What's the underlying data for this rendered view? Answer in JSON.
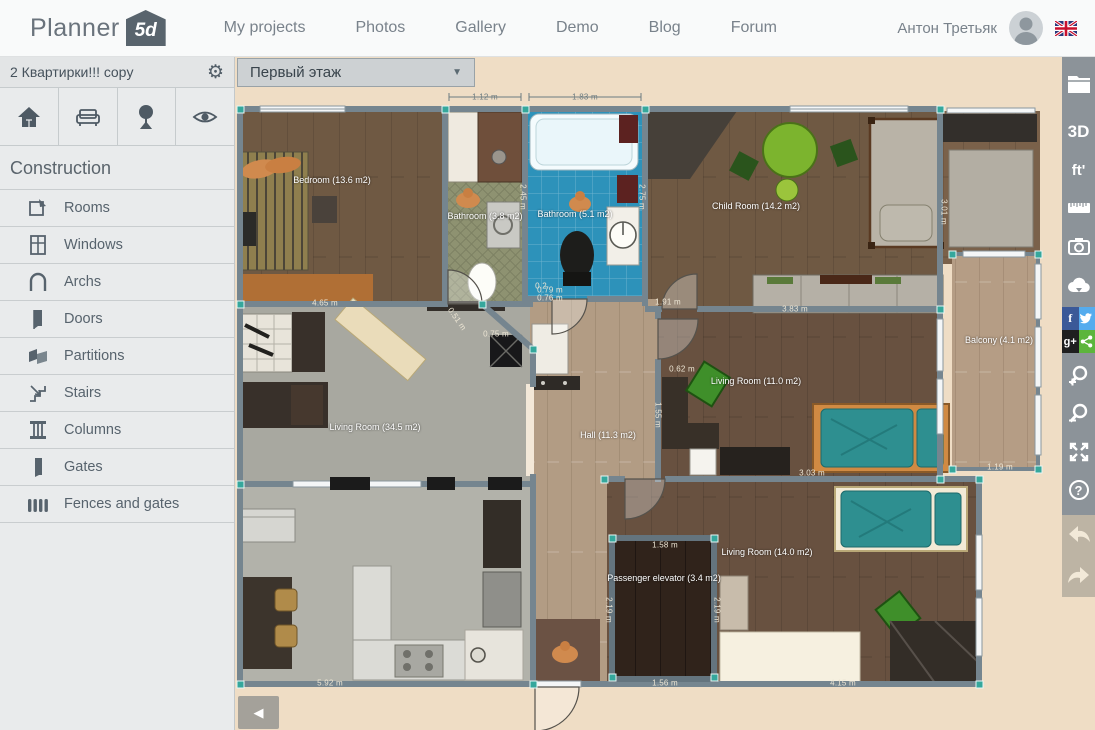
{
  "nav": {
    "logo_text": "Planner",
    "logo_badge": "5d",
    "items": [
      "My projects",
      "Photos",
      "Gallery",
      "Demo",
      "Blog",
      "Forum"
    ],
    "user_name": "Антон Третьяк"
  },
  "panel": {
    "project_title": "2 Квартирки!!! copy",
    "floor_selector": "Первый этаж",
    "section_title": "Construction",
    "items": [
      {
        "label": "Rooms"
      },
      {
        "label": "Windows"
      },
      {
        "label": "Archs"
      },
      {
        "label": "Doors"
      },
      {
        "label": "Partitions"
      },
      {
        "label": "Stairs"
      },
      {
        "label": "Columns"
      },
      {
        "label": "Gates"
      },
      {
        "label": "Fences and gates"
      }
    ]
  },
  "sidebar": {
    "view_3d_label": "3D",
    "units_label": "ft'",
    "facebook_label": "f",
    "gplus_label": "g+",
    "help_label": "?"
  },
  "floorplan": {
    "rooms": [
      {
        "name": "bedroom",
        "label": "Bedroom (13.6 m2)"
      },
      {
        "name": "bathroom-small",
        "label": "Bathroom (3.8 m2)"
      },
      {
        "name": "bathroom-large",
        "label": "Bathroom (5.1 m2)"
      },
      {
        "name": "child-room",
        "label": "Child Room (14.2 m2)"
      },
      {
        "name": "living-room-large",
        "label": "Living Room (34.5 m2)"
      },
      {
        "name": "hall",
        "label": "Hall (11.3 m2)"
      },
      {
        "name": "living-room-mid",
        "label": "Living Room (11.0 m2)"
      },
      {
        "name": "balcony",
        "label": "Balcony (4.1 m2)"
      },
      {
        "name": "living-room-bottom",
        "label": "Living Room (14.0 m2)"
      },
      {
        "name": "elevator",
        "label": "Passenger elevator (3.4 m2)"
      }
    ],
    "measurements": [
      "1.12 m",
      "1.83 m",
      "4.65 m",
      "2.45 m",
      "2.75 m",
      "0.79 m",
      "0.76 m",
      "1.91 m",
      "3.01 m",
      "3.83 m",
      "0.51 m",
      "0.75 m",
      "0.62 m",
      "1.55 m",
      "3.03 m",
      "1.19 m",
      "1.58 m",
      "1.56 m",
      "2.19 m",
      "2.19 m",
      "5.92 m",
      "4.15 m",
      "0.2"
    ]
  },
  "colors": {
    "accent_teal": "#35a79c",
    "facebook": "#3b5998",
    "twitter": "#55acee",
    "gplus_bg": "#1f1f1f",
    "share_green": "#5cb53c",
    "sidebar_bg": "#8c9399",
    "canvas_bg": "#efddc5"
  }
}
